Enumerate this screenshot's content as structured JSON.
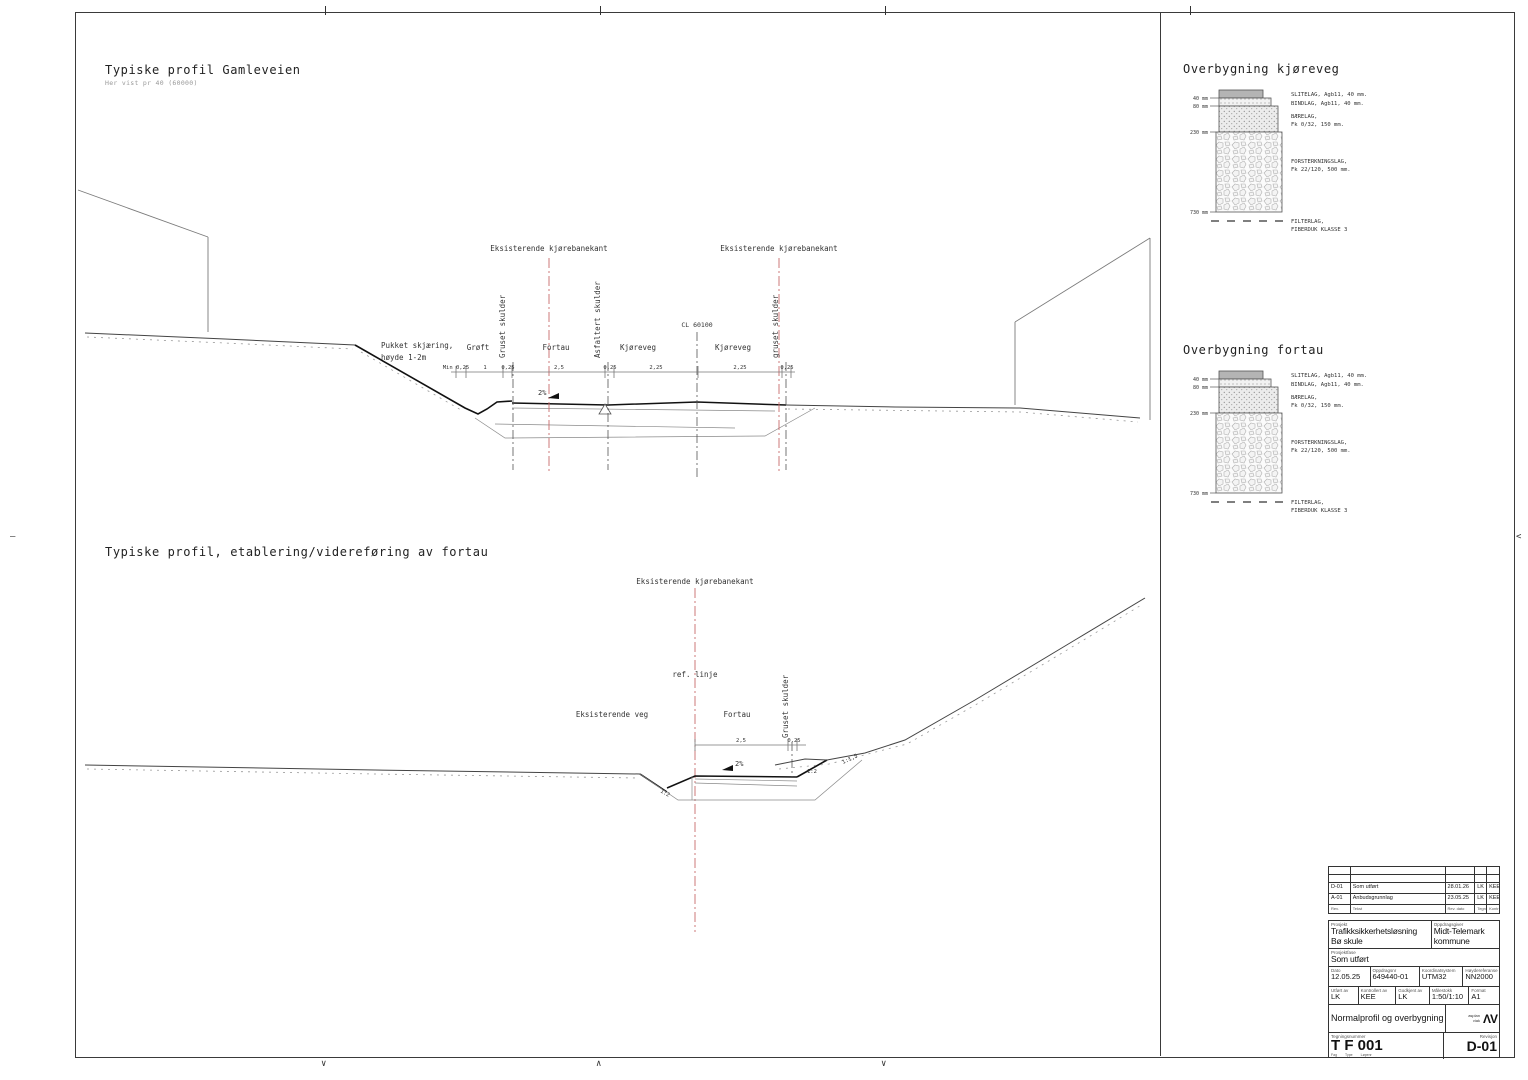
{
  "sheet": {
    "marks": {
      "down": "∨",
      "up": "∧",
      "left_dash": "–",
      "right_arrow": "<"
    }
  },
  "section1": {
    "title": "Typiske profil Gamleveien",
    "subtitle": "Her vist pr 40 (60000)"
  },
  "section2": {
    "title": "Typiske profil, etablering/videreføring av fortau"
  },
  "profile1": {
    "red_label": "Eksisterende kjørebanekant",
    "labels": {
      "pukket1": "Pukket skjæring,",
      "pukket2": "høyde 1-2m",
      "groft": "Grøft",
      "gruset_left": "Gruset skulder",
      "fortau": "Fortau",
      "asfaltert": "Asfaltert skulder",
      "kjoreveg_left": "Kjøreveg",
      "cl": "CL 60100",
      "kjoreveg_right": "Kjøreveg",
      "gruset_right": "gruset skulder",
      "slope": "2%"
    },
    "dims": [
      "Min 0,25",
      "1",
      "0,25",
      "2,5",
      "0,25",
      "2,25",
      "2,25",
      "0,25"
    ]
  },
  "profile2": {
    "red_label": "Eksisterende kjørebanekant",
    "ref_line": "ref. linje",
    "eksisterende_veg": "Eksisterende veg",
    "fortau": "Fortau",
    "gruset": "Gruset skulder",
    "dims": [
      "2,5",
      "0,25"
    ],
    "slope": "2%",
    "slope_left": "1:2",
    "slope_mid": "1:2",
    "slope_right": "1:1,5"
  },
  "overbygning_kjoreveg": {
    "title": "Overbygning kjøreveg",
    "left_dims": [
      "40 mm",
      "80 mm",
      "230 mm",
      "730 mm"
    ],
    "layers": {
      "slitelag": "SLITELAG, Agb11, 40 mm.",
      "bindlag": "BINDLAG, Agb11, 40 mm.",
      "baerelag1": "BÆRELAG,",
      "baerelag2": "Fk 0/32, 150 mm.",
      "forsterkning1": "FORSTERKNINGSLAG,",
      "forsterkning2": "Fk 22/120, 500 mm.",
      "filterlag1": "FILTERLAG,",
      "filterlag2": "FIBERDUK KLASSE 3"
    }
  },
  "overbygning_fortau": {
    "title": "Overbygning fortau",
    "left_dims": [
      "40 mm",
      "80 mm",
      "230 mm",
      "730 mm"
    ],
    "layers": {
      "slitelag": "SLITELAG, Agb11, 40 mm.",
      "bindlag": "BINDLAG, Agb11, 40 mm.",
      "baerelag1": "BÆRELAG,",
      "baerelag2": "Fk 0/32, 150 mm.",
      "forsterkning1": "FORSTERKNINGSLAG,",
      "forsterkning2": "Fk 22/120, 500 mm.",
      "filterlag1": "FILTERLAG,",
      "filterlag2": "FIBERDUK KLASSE 3"
    }
  },
  "titleblock": {
    "rev_rows": [
      {
        "rev": "D-01",
        "tekst": "Som utført",
        "dato": "28.01.26",
        "tegn": "LK",
        "kontr": "KEE"
      },
      {
        "rev": "A-01",
        "tekst": "Anbudsgrunnlag",
        "dato": "23.05.25",
        "tegn": "LK",
        "kontr": "KEE"
      }
    ],
    "rev_header": {
      "rev": "Rev.",
      "tekst": "Tekst",
      "dato": "Rev. dato",
      "tegn": "Tegn",
      "kontr": "Kontr"
    },
    "prosjekt_label": "Prosjekt",
    "prosjekt1": "Trafikksikkerhetsløsning",
    "prosjekt2": "Bø skule",
    "oppdragsgiver_label": "Oppdragsgiver",
    "oppdragsgiver1": "Midt-Telemark",
    "oppdragsgiver2": "kommune",
    "fase_label": "Prosjektfase",
    "fase": "Som utført",
    "dato_label": "Dato",
    "dato": "12.05.25",
    "oppdragsnr_label": "Oppdragsnr",
    "oppdragsnr": "649440-01",
    "koord_label": "Koordinatsystem",
    "koord": "UTM32",
    "hoyde_label": "Høydereferanse",
    "hoyde": "NN2000",
    "utfort_label": "Utført av",
    "utfort": "LK",
    "kontrollert_label": "Kontrollert av",
    "kontrollert": "KEE",
    "godkjent_label": "Godkjent av",
    "godkjent": "LK",
    "malestokk_label": "Målestokk",
    "malestokk": "1:50/1:10",
    "format_label": "Format",
    "format": "A1",
    "tegningsnavn": "Normalprofil og overbygning",
    "logo1": "asplan",
    "logo2": "viak",
    "logo_mark": "ΛV",
    "tegningsnr_label": "Tegningsnummer",
    "tegningsnr": "T F 001",
    "fag": "Fag",
    "type": "Type",
    "lopenr": "Løpenr",
    "revisjon_label": "Revisjon",
    "revisjon": "D-01"
  }
}
